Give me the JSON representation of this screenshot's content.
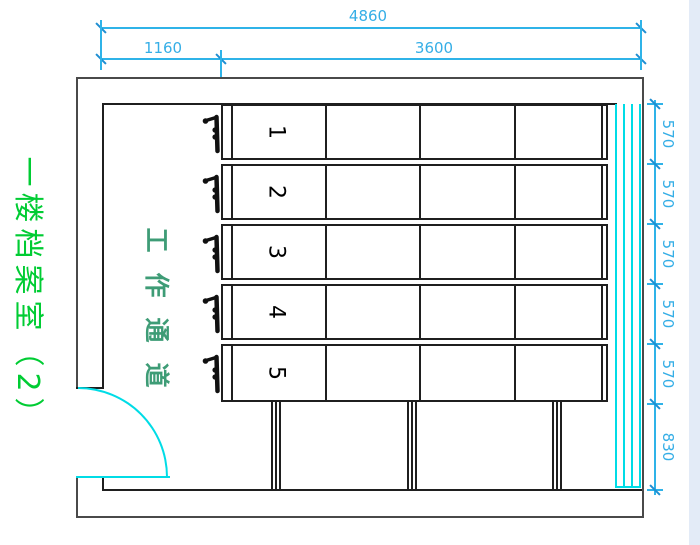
{
  "title": {
    "text": "一楼档案室（2）"
  },
  "room": {
    "passage_chars": [
      "工",
      "作",
      "通",
      "道"
    ],
    "shelf_numbers": [
      "1",
      "2",
      "3",
      "4",
      "5"
    ]
  },
  "dimensions": {
    "top_total": "4860",
    "top_left": "1160",
    "top_right": "3600",
    "right_segments": [
      "570",
      "570",
      "570",
      "570",
      "570"
    ],
    "right_bottom": "830"
  },
  "icons": {
    "crank": "shelf-crank-handle-icon",
    "door": "door-swing-arc",
    "window": "window-glazing-lines"
  },
  "colors": {
    "dimension_blue": "#2fb3e8",
    "cyan": "#00dce6",
    "title_green": "#00cc33",
    "passage_green": "#3e9c76",
    "line_black": "#1f1f1f",
    "wall_gray": "#4a4a4a"
  }
}
